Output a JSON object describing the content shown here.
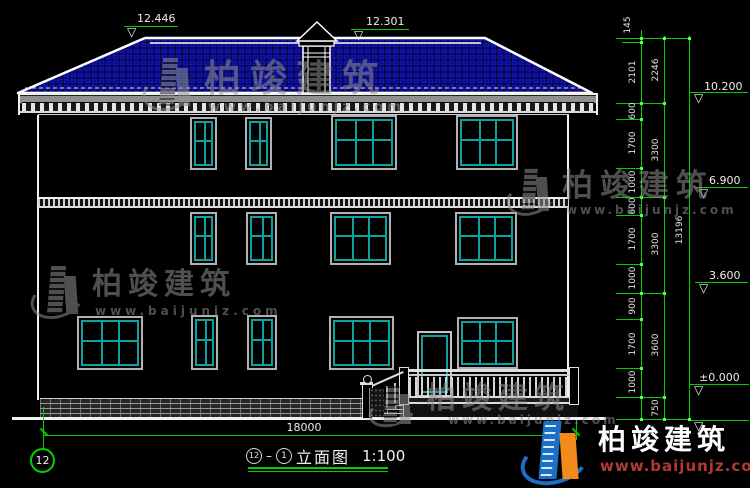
{
  "watermark": {
    "brand": "柏竣建筑",
    "url": "www.baijunjz.com"
  },
  "brand": {
    "name": "柏竣建筑",
    "url": "www.baijunjz.com"
  },
  "levels": {
    "ridge_cap": "12.446",
    "ridge": "12.301",
    "eave": "10.200",
    "f3": "6.900",
    "f2": "3.600",
    "ground": "±0.000"
  },
  "dims": {
    "col1": [
      "145",
      "2101",
      "600",
      "1700",
      "1000",
      "600",
      "1700",
      "1000",
      "900",
      "1700",
      "1000",
      "750"
    ],
    "col2": [
      "2246",
      "3300",
      "3300",
      "3600"
    ],
    "total": "13196",
    "width": "18000"
  },
  "title": {
    "axis_left": "12",
    "separator": "–",
    "axis_right": "1",
    "name": "立面图",
    "scale": "1:100"
  },
  "grid": {
    "axis": "12"
  }
}
